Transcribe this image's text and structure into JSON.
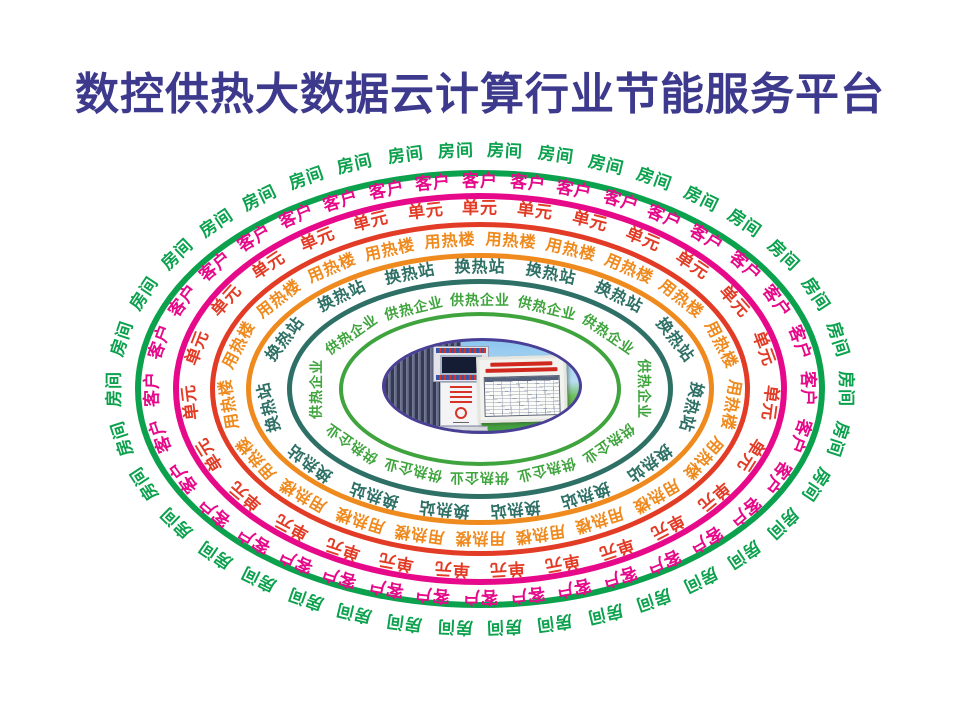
{
  "title": {
    "text": "数控供热大数据云计算行业节能服务平台"
  },
  "colors": {
    "background": "#ffffff",
    "title": "#3d3a8d",
    "center_border": "#4a3f96",
    "sky": "#8ec6ee",
    "grass": "#3f9e3c",
    "board_red": "#d0281e",
    "ring_room": "#0ba14d",
    "ring_customer": "#e60a8a",
    "ring_unit": "#e23b26",
    "ring_heat_building": "#ef8a1e",
    "ring_heat_exchange_station": "#2e7065",
    "ring_heating_enterprise": "#3fa43d"
  },
  "rings": [
    {
      "id": "room",
      "label": "房间",
      "color": "#0ba14d",
      "count": 38,
      "text_rx": 365,
      "text_ry": 238,
      "line_rx": 345,
      "line_ry": 219,
      "line_width": 6,
      "font_size": 17,
      "phase": 0.5
    },
    {
      "id": "customer",
      "label": "客户",
      "color": "#e60a8a",
      "count": 36,
      "text_rx": 327,
      "text_ry": 207,
      "line_rx": 307,
      "line_ry": 196,
      "line_width": 6,
      "font_size": 17,
      "phase": 0.0
    },
    {
      "id": "unit",
      "label": "单元",
      "color": "#e23b26",
      "count": 27,
      "text_rx": 290,
      "text_ry": 180,
      "line_rx": 270,
      "line_ry": 167,
      "line_width": 5,
      "font_size": 17,
      "phase": 0.0
    },
    {
      "id": "heat-building",
      "label": "用热楼",
      "color": "#ef8a1e",
      "count": 21,
      "text_rx": 252,
      "text_ry": 149,
      "line_rx": 234,
      "line_ry": 136,
      "line_width": 5,
      "font_size": 16,
      "phase": 0.5
    },
    {
      "id": "heat-exchange-station",
      "label": "换热站",
      "color": "#2e7065",
      "count": 15,
      "text_rx": 213,
      "text_ry": 122,
      "line_rx": 193,
      "line_ry": 110,
      "line_width": 5,
      "font_size": 16,
      "phase": 0.0
    },
    {
      "id": "heating-enterprise",
      "label": "供热企业",
      "color": "#3fa43d",
      "count": 12,
      "text_rx": 163,
      "text_ry": 88,
      "line_rx": 141,
      "line_ry": 77,
      "line_width": 4,
      "font_size": 14,
      "phase": 0.0
    }
  ],
  "center": {
    "cx": 480,
    "cy": 389
  }
}
